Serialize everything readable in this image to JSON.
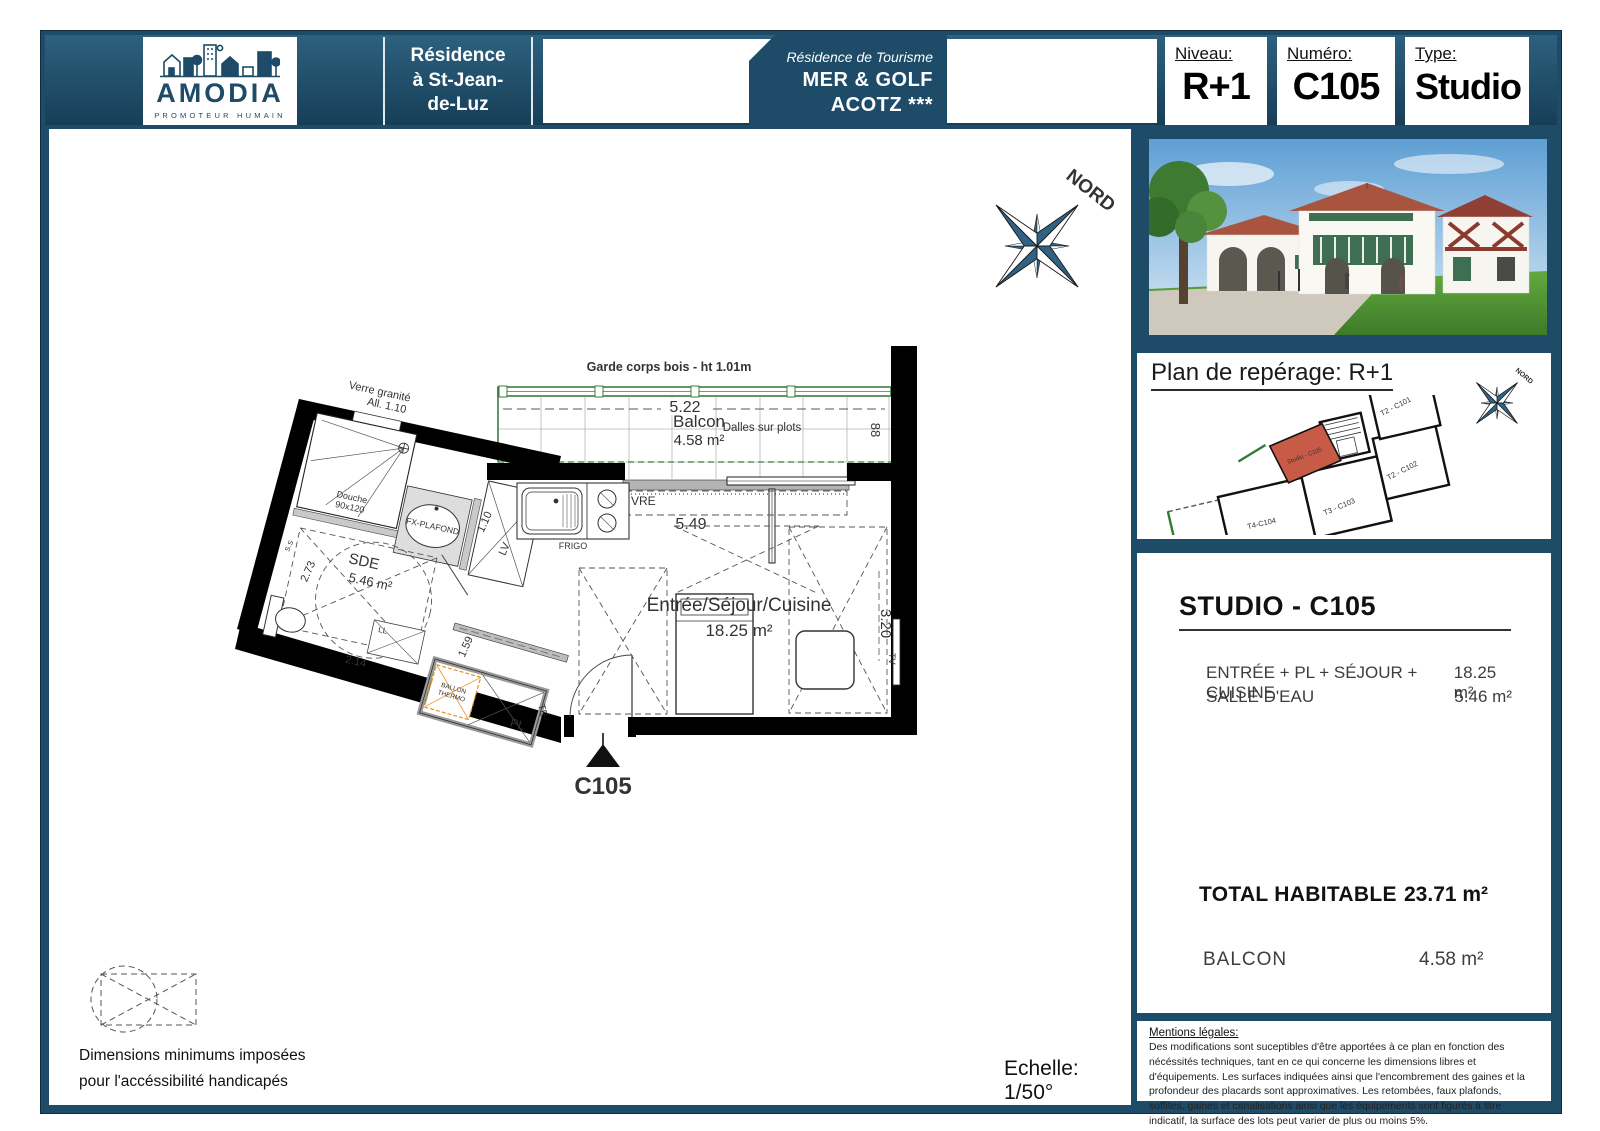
{
  "header": {
    "brand": {
      "name": "AMODIA",
      "tagline": "PROMOTEUR HUMAIN"
    },
    "residence": "Résidence\nà St-Jean-\nde-Luz",
    "tourism": {
      "line1": "Résidence de Tourisme",
      "line2": "MER & GOLF",
      "line3": "ACOTZ ***"
    },
    "fields": [
      {
        "label": "Niveau:",
        "value": "R+1"
      },
      {
        "label": "Numéro:",
        "value": "C105"
      },
      {
        "label": "Type:",
        "value": "Studio"
      }
    ]
  },
  "plan": {
    "north_label": "NORD",
    "balcony": {
      "railing_note": "Garde corps bois - ht 1.01m",
      "name": "Balcon",
      "area": "4.58 m²",
      "slab_note": "Dalles sur plots",
      "width_dim": "5.22",
      "depth_dim": "88"
    },
    "main_room": {
      "name": "Entrée/Séjour/Cuisine",
      "area": "18.25 m²",
      "width_dim": "5.49",
      "depth_dim": "3.20"
    },
    "bathroom": {
      "name": "SDE",
      "area": "5.46 m²",
      "dim1": "2.73",
      "dim2": "2.14",
      "dim3": "1.59",
      "shower_line1": "Douche",
      "shower_line2": "90x120",
      "ceiling_note": "FX-PLAFOND",
      "ss": "S.S"
    },
    "window_note": {
      "line1": "Verre granité",
      "line2": "All. 1.10"
    },
    "labels": {
      "ob": "OB",
      "vre": "VRE",
      "frigo": "FRIGO",
      "lv": "LV",
      "lv_dim": "1.10",
      "pl": "PL",
      "te": "TE",
      "ll": "LL",
      "tv": "TV",
      "ballon_line1": "BALLON",
      "ballon_line2": "THERMO"
    },
    "unit": "C105",
    "scale": "Echelle: 1/50°",
    "accessibility": {
      "line1": "Dimensions minimums imposées",
      "line2": "pour l'accéssibilité handicapés"
    }
  },
  "sidebar": {
    "reperage": {
      "title": "Plan de repérage: R+1",
      "north_label": "NORD",
      "highlight_label": "Studio - C105",
      "units": {
        "t2a": "T2 - C101",
        "t2b": "T2 - C102",
        "t3": "T3 - C103",
        "t4": "T4-C104"
      }
    },
    "details": {
      "title": "STUDIO - C105",
      "rows": [
        {
          "label": "ENTRÉE + PL + SÉJOUR + CUISINE",
          "value": "18.25 m²"
        },
        {
          "label": "SALLE D'EAU",
          "value": "5.46 m²"
        }
      ],
      "total_label": "TOTAL HABITABLE",
      "total_value": "23.71 m²",
      "balcony_label": "BALCON",
      "balcony_value": "4.58 m²"
    },
    "legal": {
      "title": "Mentions légales:",
      "body": "Des modifications sont suceptibles d'être apportées à ce plan en fonction des nécéssités techniques, tant en ce qui concerne les dimensions libres et d'équipements. Les surfaces indiquées ainsi que l'encombrement des gaines et la profondeur des placards sont approximatives. Les retombées, faux plafonds, soffites, gaines et canalisations ainsi que les équipements sont figurés à titre indicatif, la surface des lots peut varier de plus ou moins 5%."
    }
  },
  "colors": {
    "frame": "#1d4b68",
    "green": "#3c7d3f",
    "orange": "#e8941c",
    "highlight": "#c75b47"
  }
}
